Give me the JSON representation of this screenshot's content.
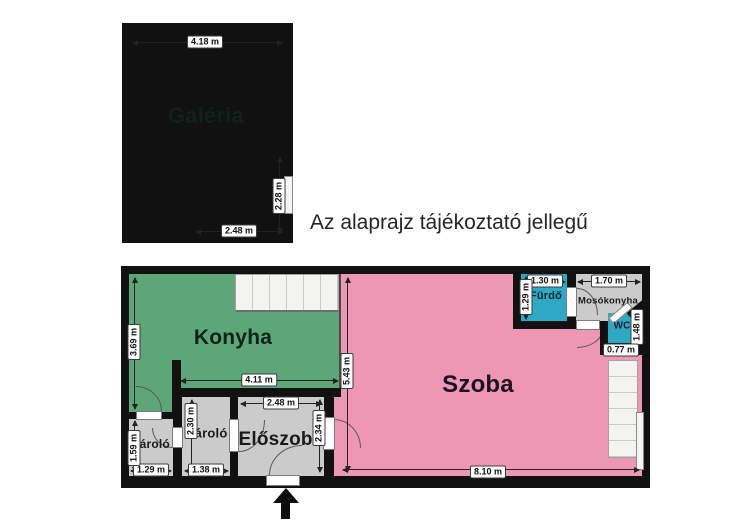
{
  "note": "Az alaprajz tájékoztató jellegű",
  "colors": {
    "tan": "#F2D9A8",
    "green": "#5CA677",
    "pink": "#EE97B4",
    "teal": "#2EA9C4",
    "roomGray": "#CBCBCB",
    "wall": "#111111",
    "stairs": "#F3F3F1"
  },
  "gallery": {
    "label": "Galéria",
    "dim_top": "4.18 m",
    "dim_right": "2.28 m",
    "dim_bottom": "2.48 m"
  },
  "floor": {
    "kitchen": "Konyha",
    "kitchen_h": "3.69 m",
    "kitchen_w": "4.11 m",
    "room": "Szoba",
    "room_h": "5.43 m",
    "room_w": "8.10 m",
    "hall": "Előszoba",
    "hall_w": "2.48 m",
    "hall_h": "2.34 m",
    "storage1": "Tároló",
    "storage1_w": "1.29 m",
    "storage1_h": "1.59 m",
    "storage2": "Tároló",
    "storage2_w": "1.38 m",
    "storage2_h": "2.30 m",
    "bath": "Fürdő",
    "bath_w": "1.30 m",
    "bath_h": "1.29 m",
    "laundry": "Mosókonyha",
    "laundry_w": "1.70 m",
    "wc": "WC",
    "wc_w": "0.77 m",
    "wc_h": "1.48 m"
  }
}
